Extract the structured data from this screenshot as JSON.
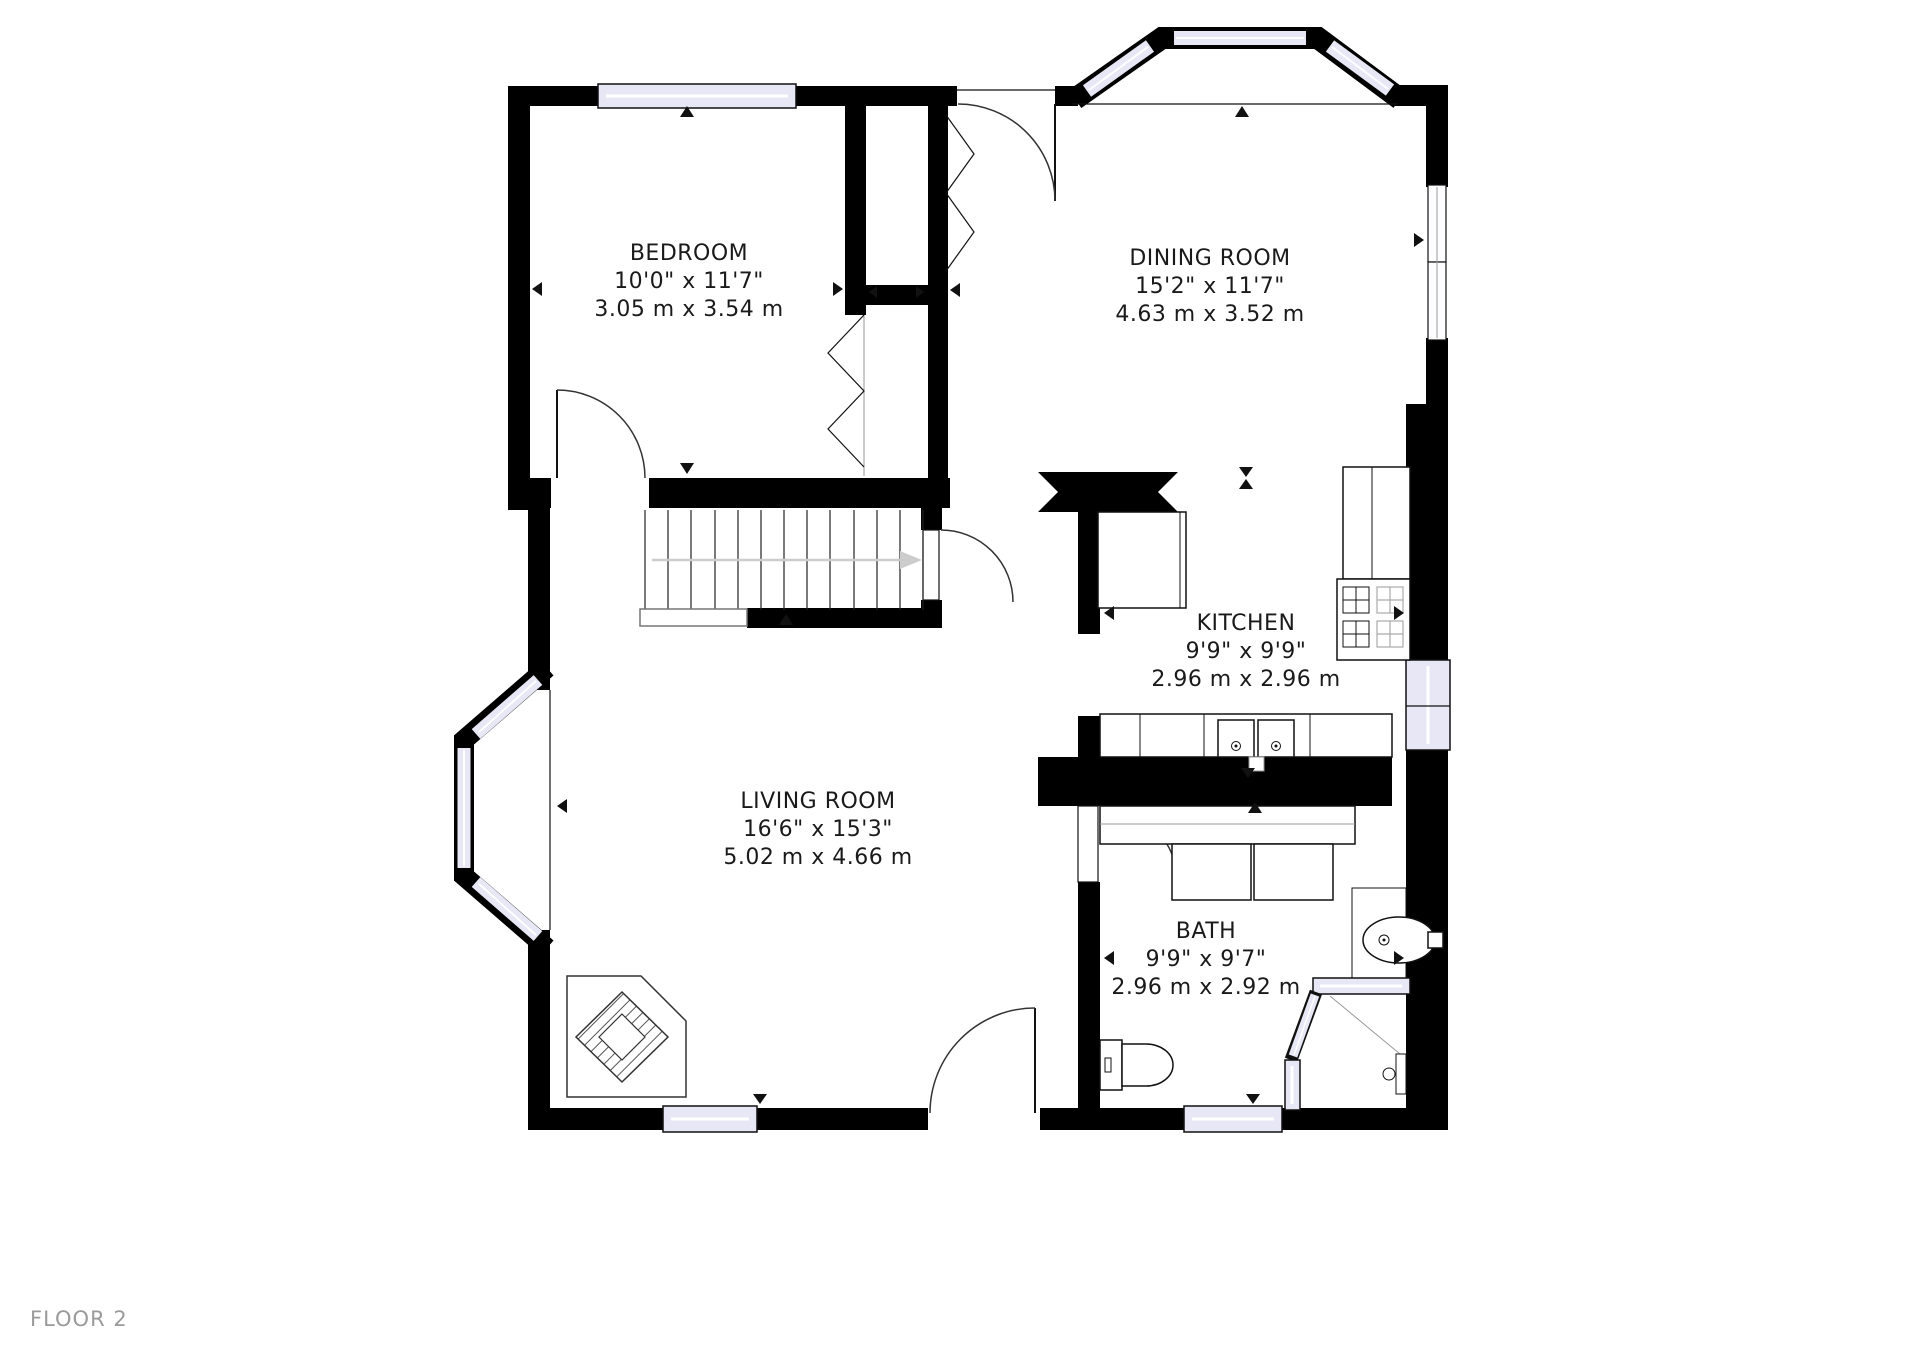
{
  "floor_label": "FLOOR 2",
  "rooms": [
    {
      "name": "BEDROOM",
      "imperial": "10'0\" x 11'7\"",
      "metric": "3.05 m x 3.54 m"
    },
    {
      "name": "DINING ROOM",
      "imperial": "15'2\" x 11'7\"",
      "metric": "4.63 m x 3.52 m"
    },
    {
      "name": "KITCHEN",
      "imperial": "9'9\" x 9'9\"",
      "metric": "2.96 m x 2.96 m"
    },
    {
      "name": "LIVING ROOM",
      "imperial": "16'6\" x 15'3\"",
      "metric": "5.02 m x 4.66 m"
    },
    {
      "name": "BATH",
      "imperial": "9'9\" x 9'7\"",
      "metric": "2.96 m x 2.92 m"
    }
  ],
  "icons": [
    "stove-icon",
    "kitchen-sink-icon",
    "bathroom-sink-icon",
    "toilet-icon",
    "shower-icon",
    "fireplace-icon",
    "stairs-icon",
    "window-icon",
    "door-icon"
  ],
  "colors": {
    "wall": "#000000",
    "window_glass": "#e7e7f5",
    "room_text": "#1a1a1a",
    "floor_label_text": "#9a9a9a",
    "stairs_arrow": "#cccccc"
  }
}
